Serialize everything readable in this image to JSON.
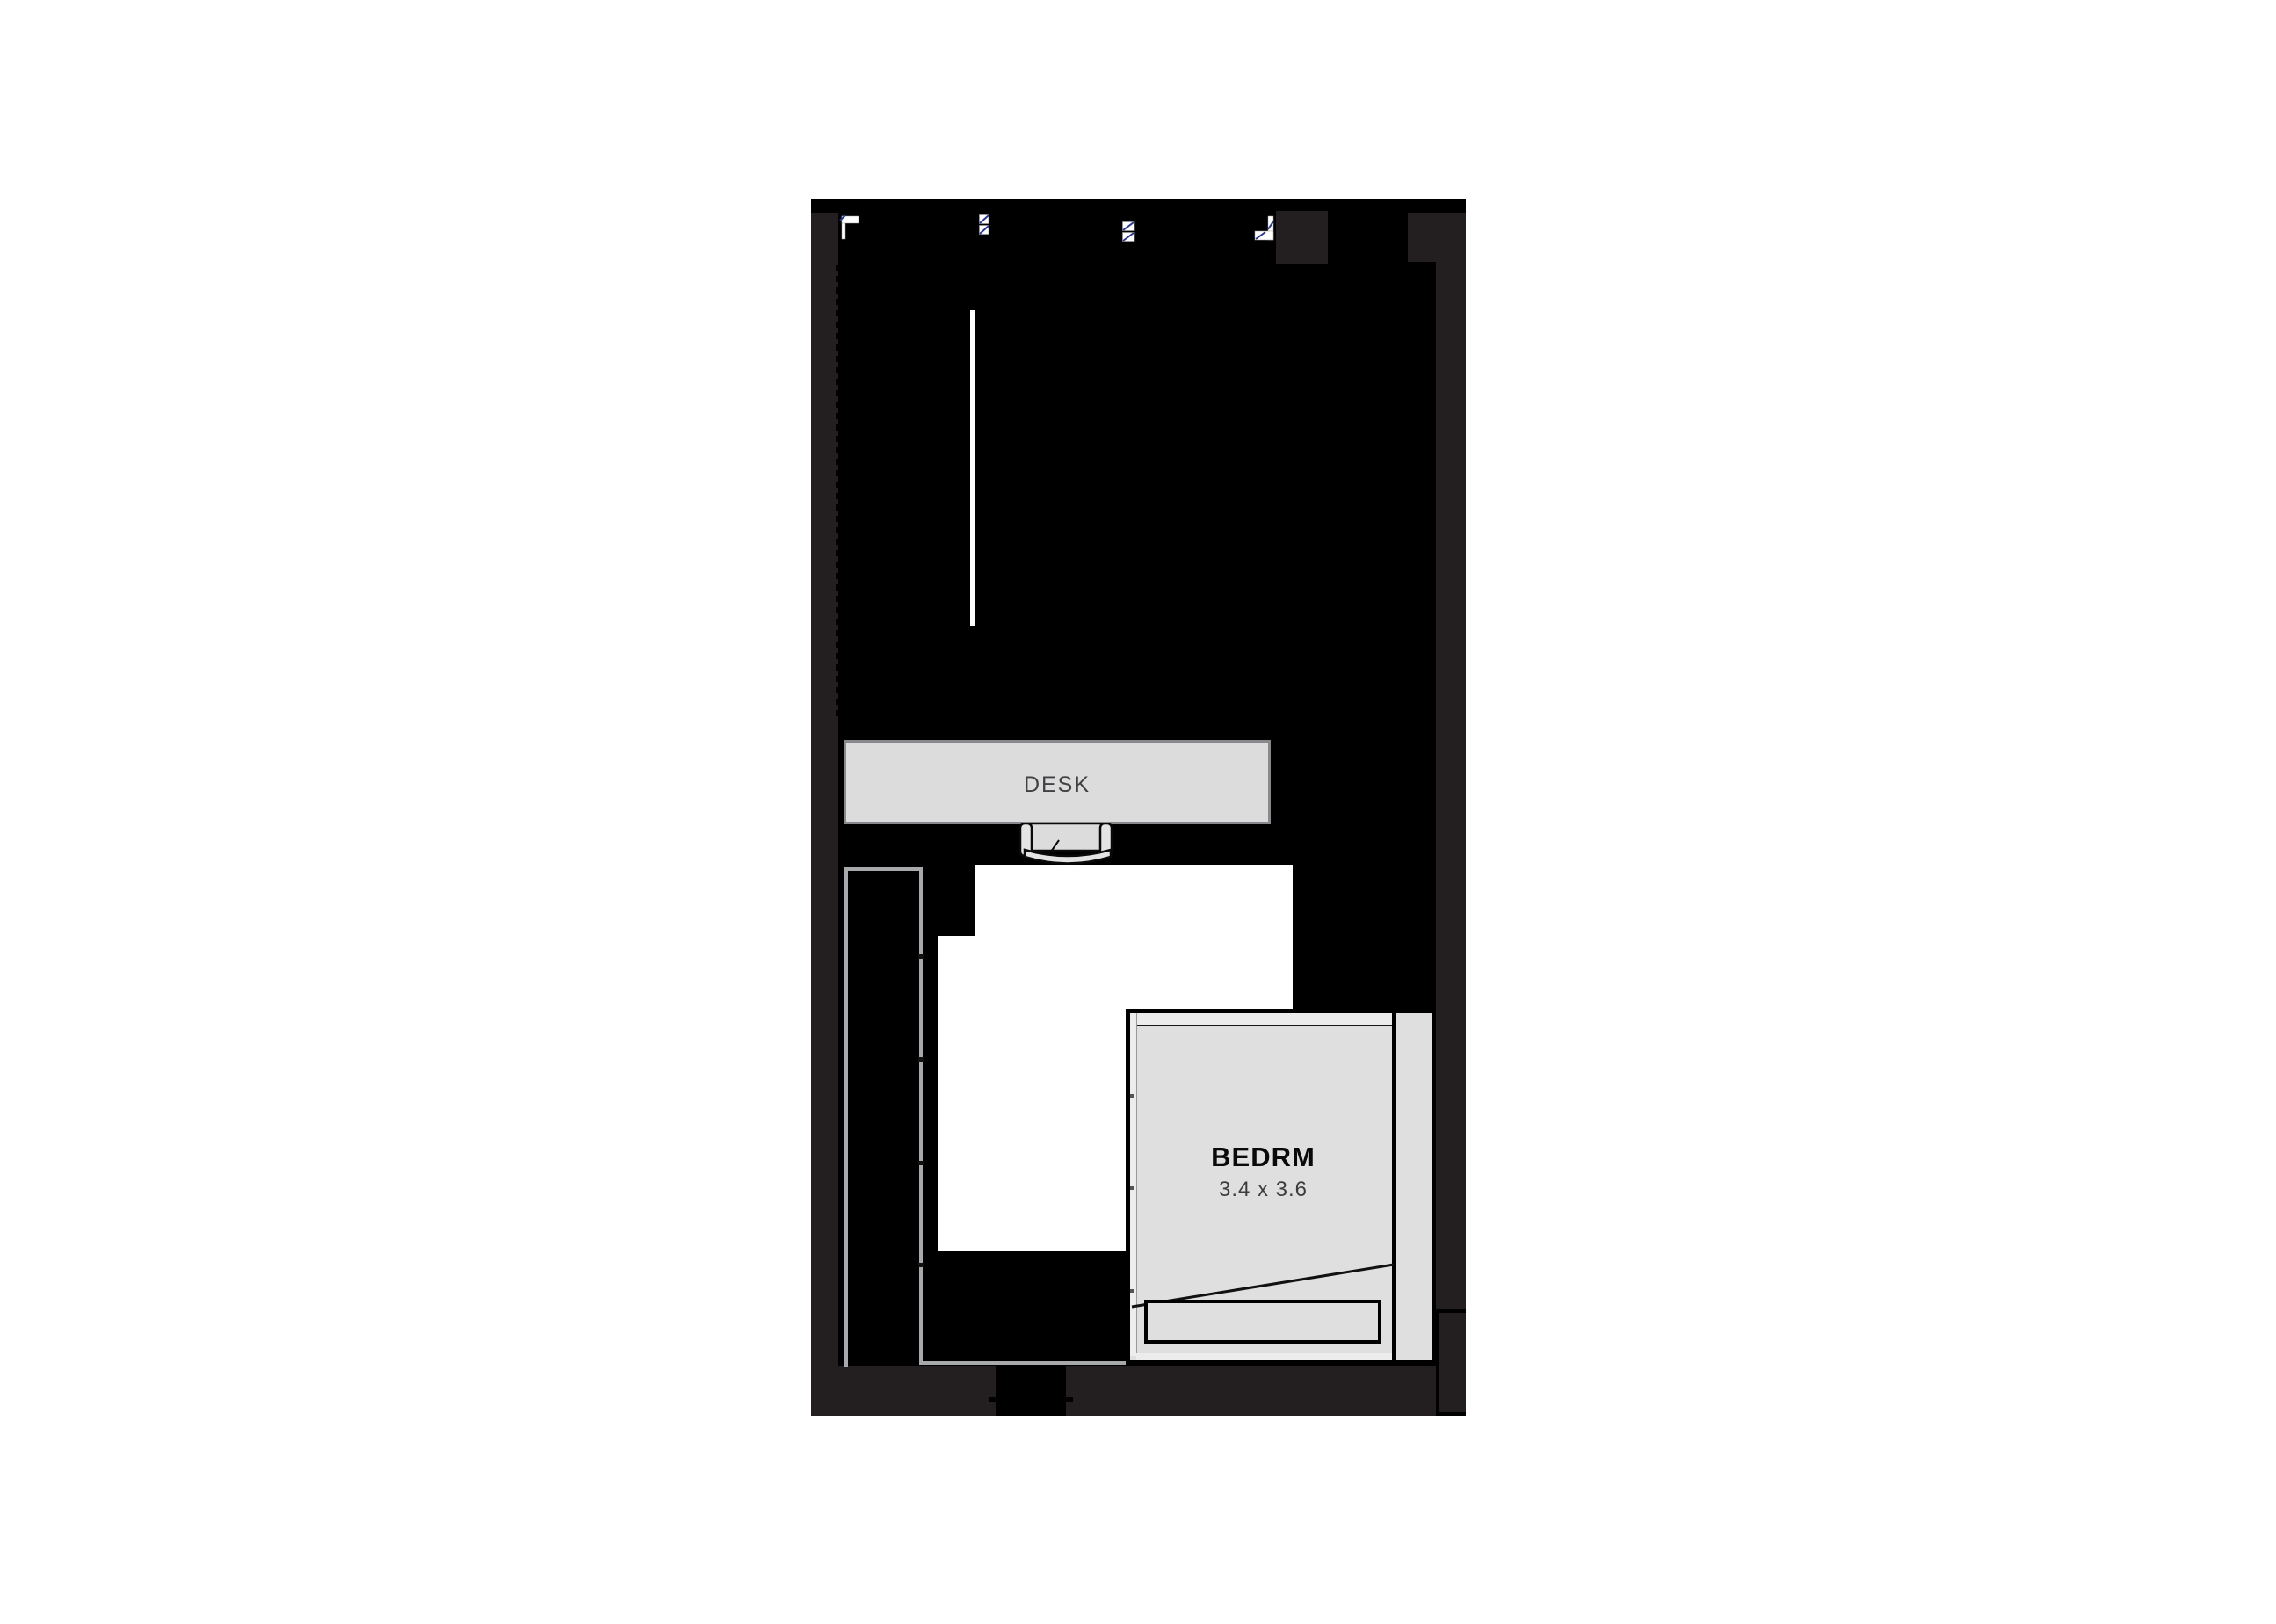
{
  "floorplan": {
    "labels": {
      "desk": "DESK",
      "bedroom_name": "BEDRM",
      "bedroom_dims": "3.4 x 3.6"
    },
    "icons": [
      "window-start-marker-icon",
      "window-hatch-marker-icon",
      "window-hatch-marker-icon",
      "window-end-marker-icon"
    ],
    "colors": {
      "ink": "#000000",
      "wall": "#231f20",
      "furn": "#dcdcdd",
      "room": "#dfdfdf",
      "band": "#ececec",
      "outline": "#87898c",
      "grayline": "#a7a9ac",
      "blue": "#2b3990",
      "textdark": "#414042",
      "white": "#ffffff"
    }
  }
}
